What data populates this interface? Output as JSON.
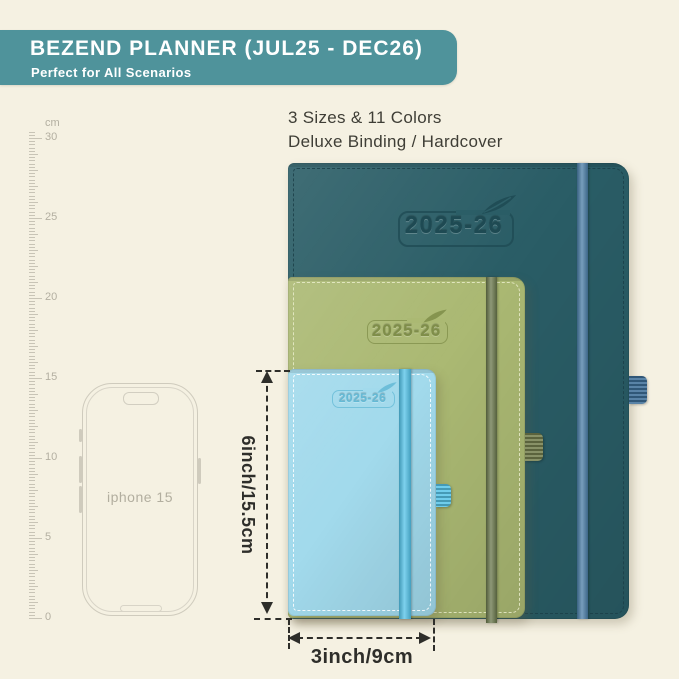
{
  "header": {
    "title": "BEZEND PLANNER (JUL25 - DEC26)",
    "subtitle": "Perfect for All Scenarios",
    "bg_color": "#4f939b",
    "text_color": "#ffffff"
  },
  "intro": {
    "line1": "3 Sizes & 11 Colors",
    "line2": "Deluxe Binding / Hardcover"
  },
  "ruler": {
    "unit": "cm",
    "major_labels": [
      "30",
      "25",
      "20",
      "15",
      "10",
      "5",
      "0"
    ]
  },
  "phone": {
    "label": "iphone 15"
  },
  "planners": [
    {
      "name": "large-planner",
      "year": "2025-26",
      "cover": "#2a5d66",
      "band": "#4a7da6",
      "stitch": "#1c4049",
      "emboss": "#1e4a53",
      "loop": "#3e6f99"
    },
    {
      "name": "medium-planner",
      "year": "2025-26",
      "cover": "#abb973",
      "band": "#68764a",
      "stitch": "#e9ecca",
      "emboss": "#7f8e49",
      "loop": "#747f4e"
    },
    {
      "name": "small-planner",
      "year": "2025-26",
      "cover": "#a2daec",
      "band": "#52c2e8",
      "stitch": "#ffffff",
      "emboss": "#64bad6",
      "loop": "#58c5e9"
    }
  ],
  "dimensions": {
    "height_label": "6inch/15.5cm",
    "width_label": "3inch/9cm",
    "line_color": "#2e2e2a"
  }
}
